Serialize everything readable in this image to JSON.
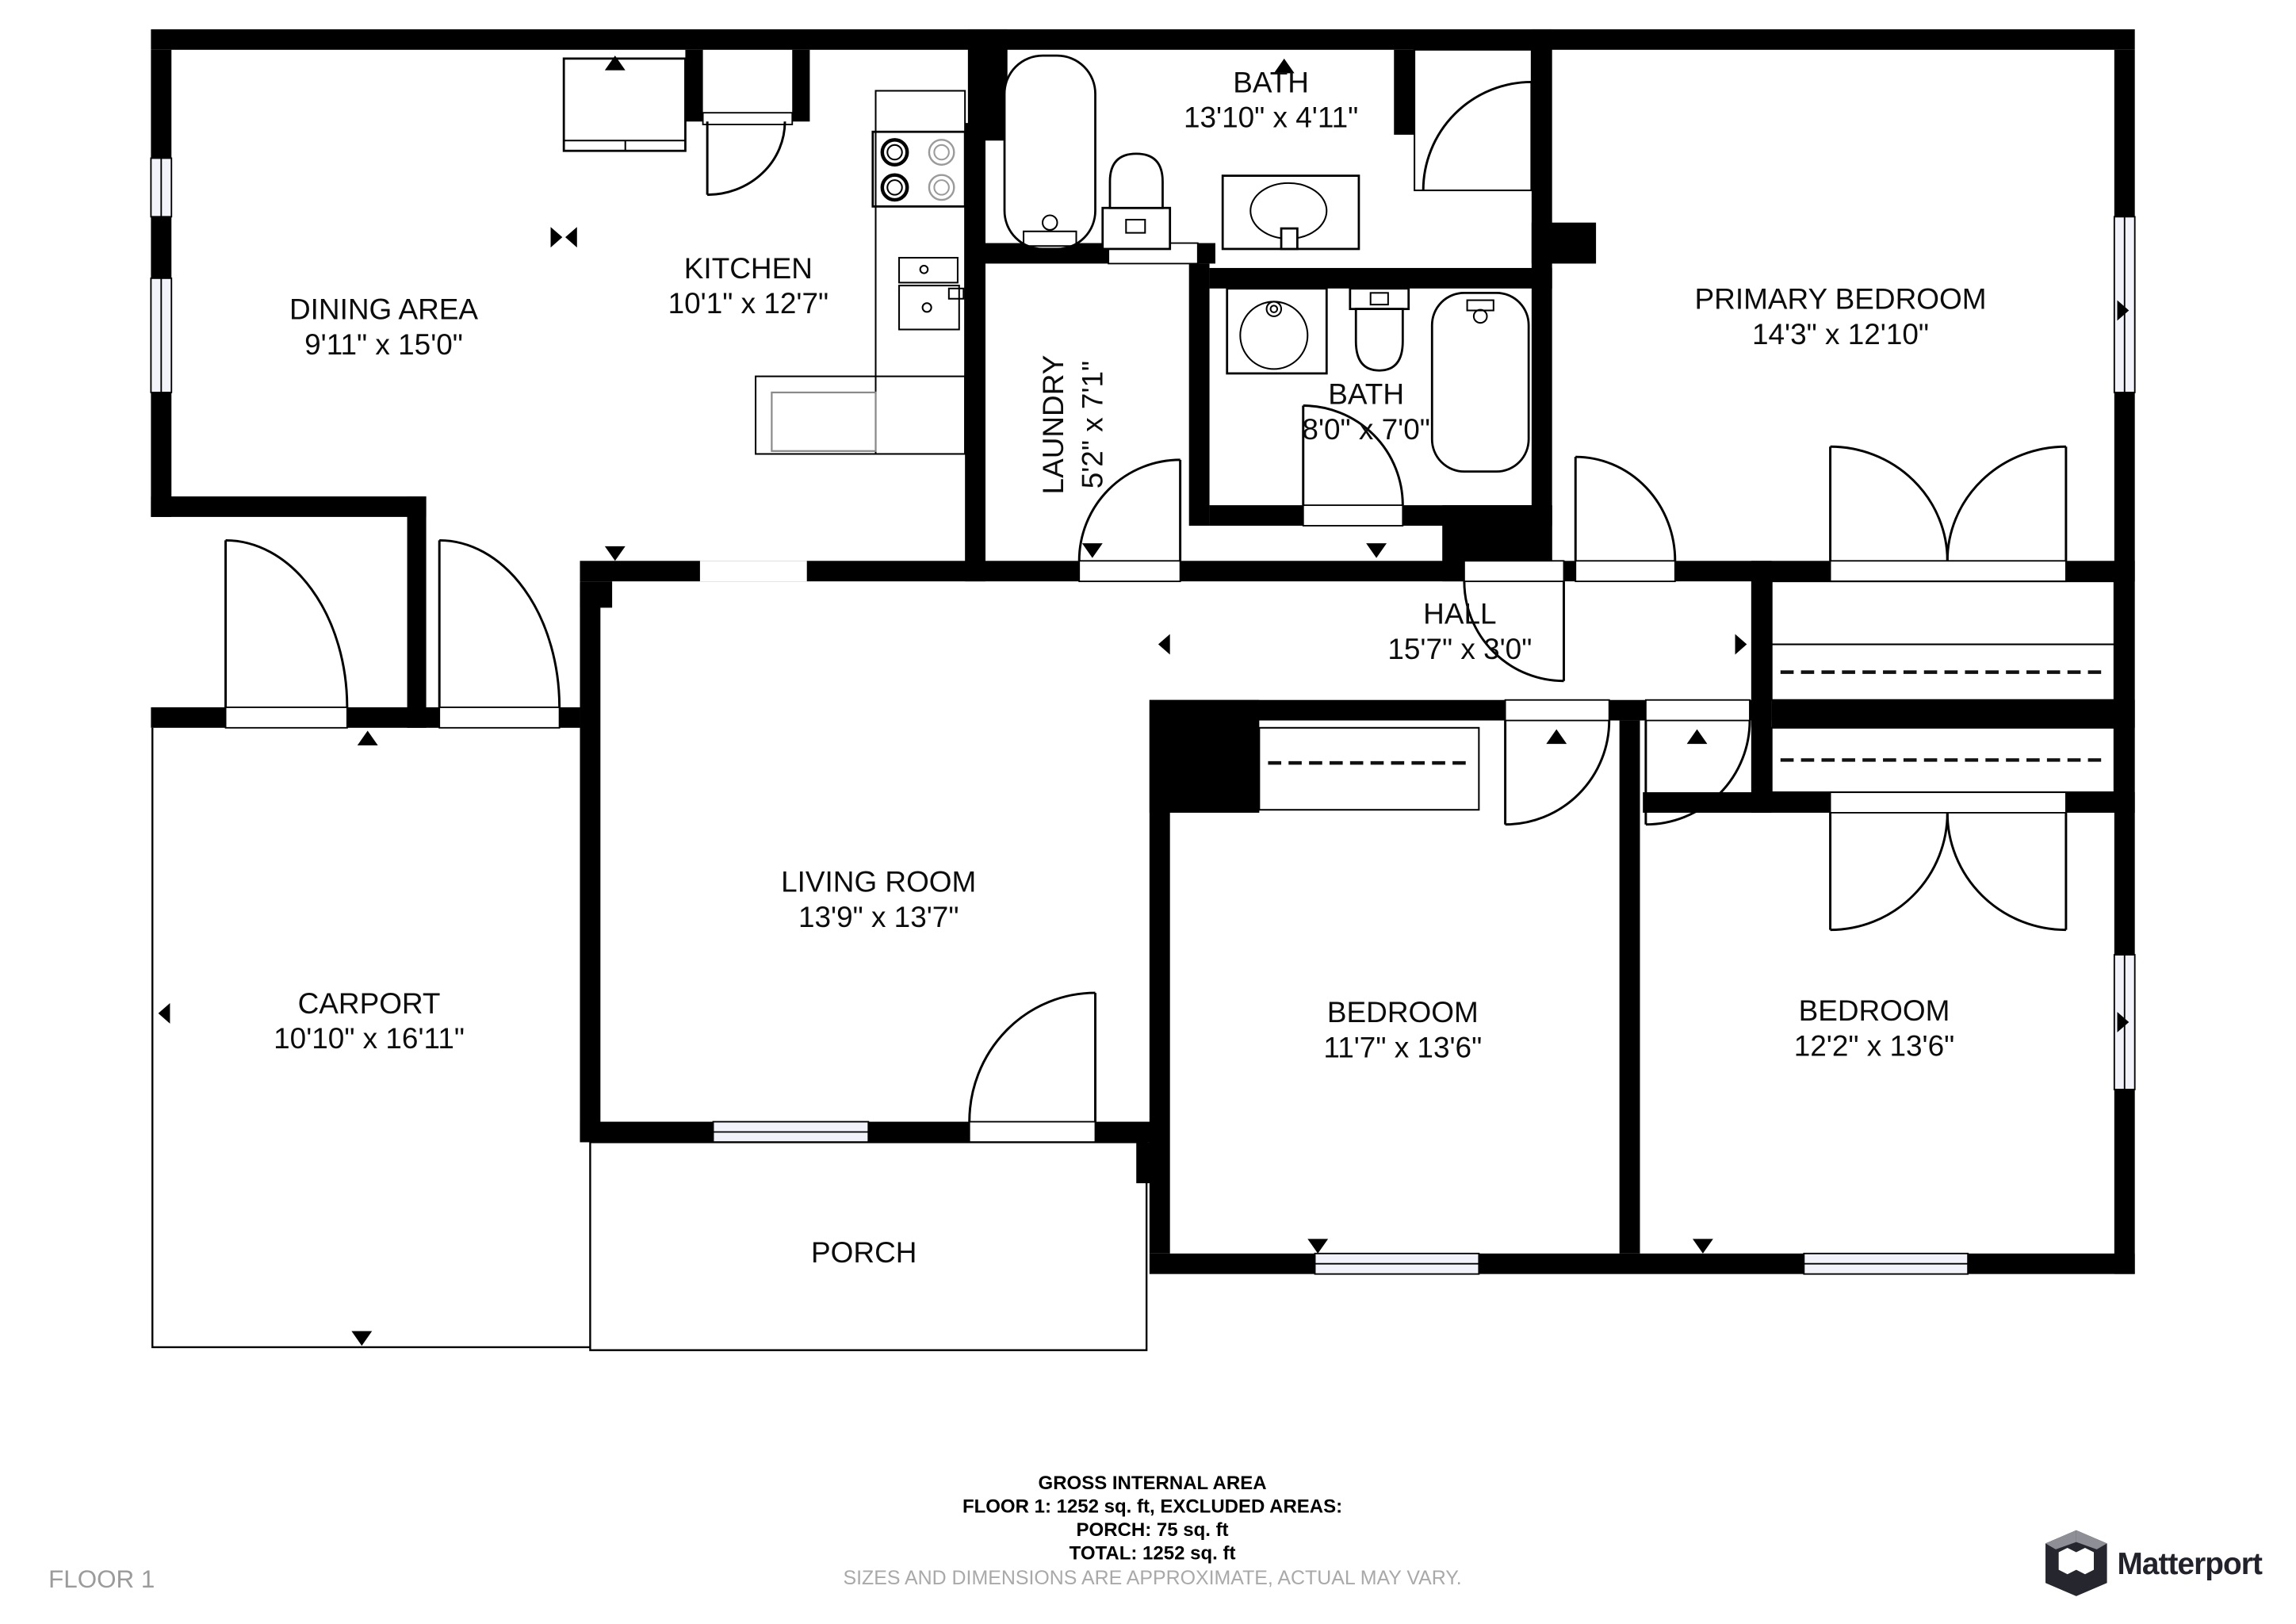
{
  "rooms": {
    "dining": {
      "name": "DINING AREA",
      "dims": "9'11\" x 15'0\""
    },
    "kitchen": {
      "name": "KITCHEN",
      "dims": "10'1\" x 12'7\""
    },
    "bath_top": {
      "name": "BATH",
      "dims": "13'10\" x 4'11\""
    },
    "primary": {
      "name": "PRIMARY BEDROOM",
      "dims": "14'3\" x 12'10\""
    },
    "laundry": {
      "name": "LAUNDRY",
      "dims": "5'2\" x 7'1\""
    },
    "bath_hall": {
      "name": "BATH",
      "dims": "8'0\" x 7'0\""
    },
    "hall": {
      "name": "HALL",
      "dims": "15'7\" x 3'0\""
    },
    "living": {
      "name": "LIVING ROOM",
      "dims": "13'9\" x 13'7\""
    },
    "carport": {
      "name": "CARPORT",
      "dims": "10'10\" x 16'11\""
    },
    "bedroom_mid": {
      "name": "BEDROOM",
      "dims": "11'7\" x 13'6\""
    },
    "bedroom_right": {
      "name": "BEDROOM",
      "dims": "12'2\" x 13'6\""
    },
    "porch": {
      "name": "PORCH"
    }
  },
  "footer": {
    "gross_title": "GROSS INTERNAL AREA",
    "floor_line": "FLOOR 1: 1252 sq. ft, EXCLUDED AREAS:",
    "porch_line": "PORCH: 75 sq. ft",
    "total_line": "TOTAL: 1252 sq. ft",
    "disclaimer": "SIZES AND DIMENSIONS ARE APPROXIMATE, ACTUAL MAY VARY.",
    "floor_label": "FLOOR 1"
  },
  "branding": {
    "wordmark": "Matterport"
  },
  "colors": {
    "wall": "#000000",
    "window_fill": "#f1f2fa",
    "muted_text": "#9b9b9b",
    "logo_dark": "#26262e",
    "logo_gray": "#8e8e96"
  }
}
